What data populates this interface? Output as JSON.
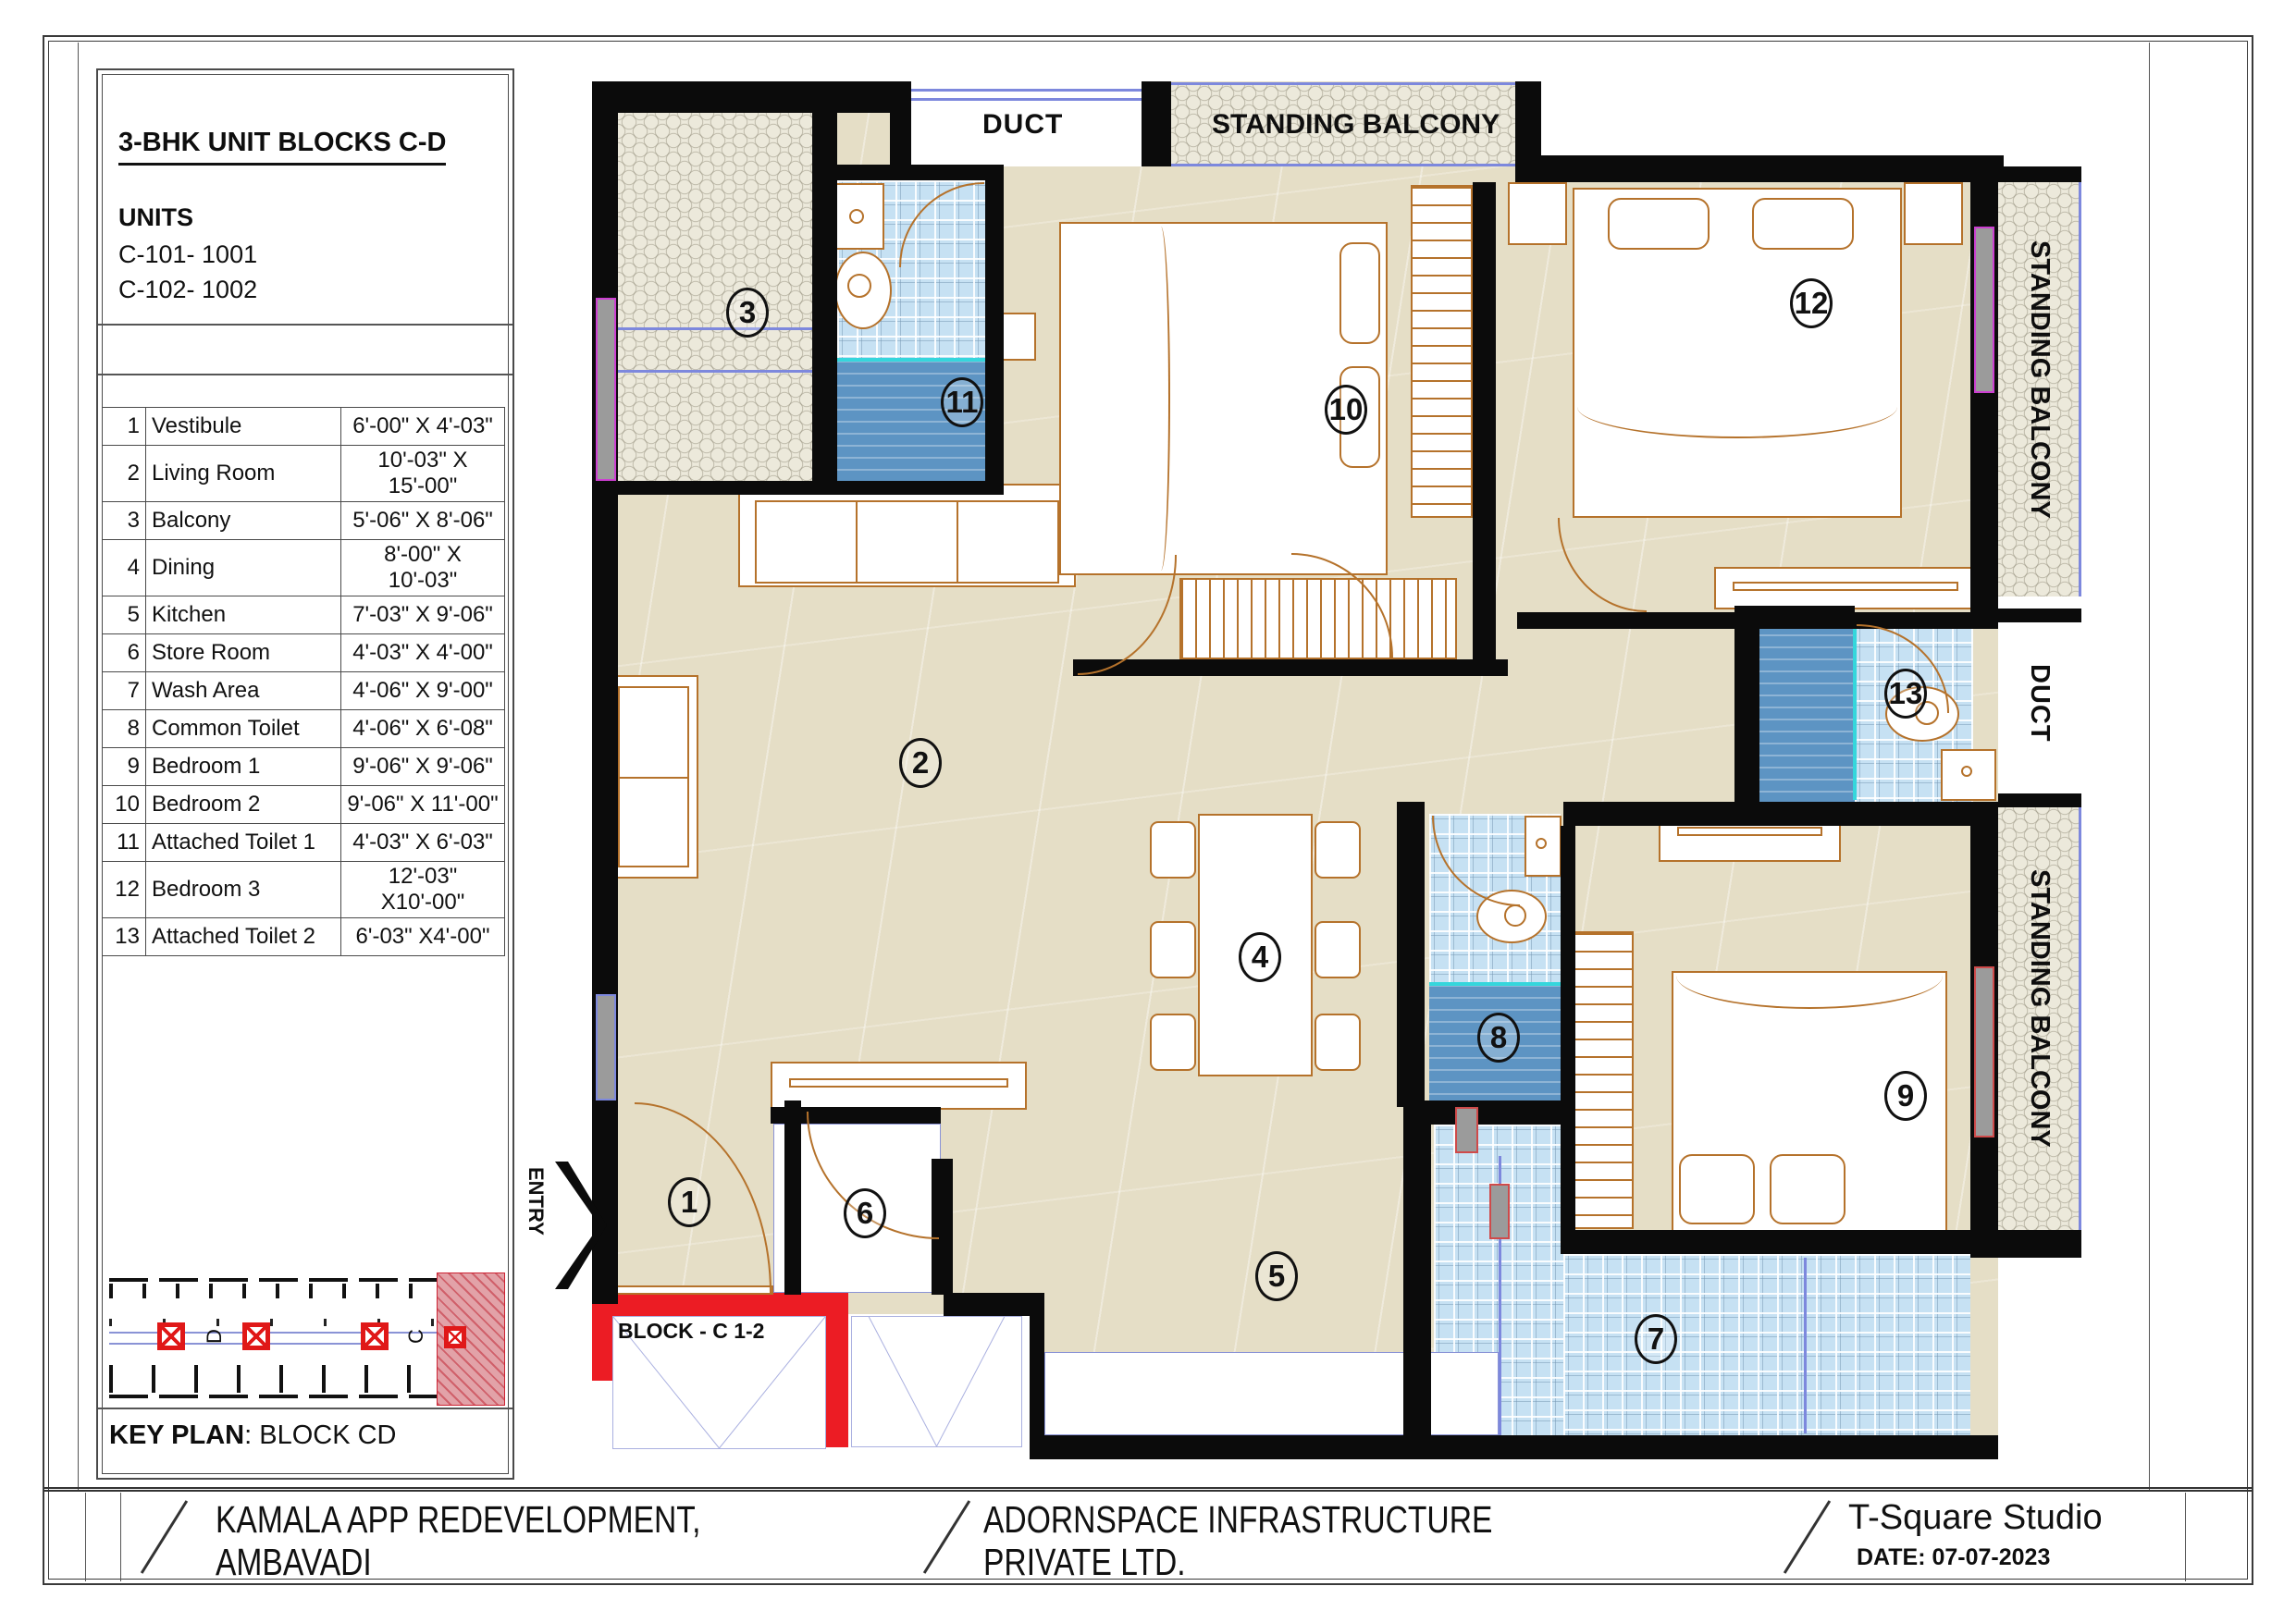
{
  "title_block": {
    "title": "3-BHK UNIT BLOCKS C-D",
    "units_heading": "UNITS",
    "unit_1": "C-101- 1001",
    "unit_2": "C-102- 1002"
  },
  "room_table": {
    "rows": [
      {
        "no": "1",
        "name": "Vestibule",
        "size": "6'-00\" X 4'-03\""
      },
      {
        "no": "2",
        "name": "Living Room",
        "size": "10'-03\" X 15'-00\""
      },
      {
        "no": "3",
        "name": "Balcony",
        "size": "5'-06\" X 8'-06\""
      },
      {
        "no": "4",
        "name": "Dining",
        "size": "8'-00\" X 10'-03\""
      },
      {
        "no": "5",
        "name": "Kitchen",
        "size": "7'-03\" X 9'-06\""
      },
      {
        "no": "6",
        "name": "Store Room",
        "size": "4'-03\" X 4'-00\""
      },
      {
        "no": "7",
        "name": "Wash Area",
        "size": "4'-06\" X 9'-00\""
      },
      {
        "no": "8",
        "name": "Common Toilet",
        "size": "4'-06\" X 6'-08\""
      },
      {
        "no": "9",
        "name": "Bedroom 1",
        "size": "9'-06\" X 9'-06\""
      },
      {
        "no": "10",
        "name": "Bedroom 2",
        "size": "9'-06\" X 11'-00\""
      },
      {
        "no": "11",
        "name": "Attached Toilet 1",
        "size": "4'-03\" X 6'-03\""
      },
      {
        "no": "12",
        "name": "Bedroom 3",
        "size": "12'-03\" X10'-00\""
      },
      {
        "no": "13",
        "name": "Attached Toilet 2",
        "size": "6'-03\" X4'-00\""
      }
    ]
  },
  "key_plan": {
    "label": "KEY PLAN",
    "value": ": BLOCK CD",
    "block_d": "D",
    "block_c": "C"
  },
  "plan": {
    "duct_top": "DUCT",
    "balcony_top": "STANDING BALCONY",
    "balcony_right_upper": "STANDING BALCONY",
    "duct_right": "DUCT",
    "balcony_right_lower": "STANDING BALCONY",
    "entry": "ENTRY",
    "block_label": "BLOCK - C 1-2"
  },
  "footer": {
    "project_line1": "KAMALA APP REDEVELOPMENT,",
    "project_line2": "AMBAVADI",
    "company_line1": "ADORNSPACE INFRASTRUCTURE",
    "company_line2": "PRIVATE LTD.",
    "studio": "T-Square Studio",
    "date": "DATE: 07-07-2023"
  },
  "colors": {
    "wall": "#0b0b0b",
    "floor": "#e5dec6",
    "tile_light": "#c6e1f3",
    "tile_dark": "#5d94c3",
    "furniture_line": "#b5722b",
    "entry_red": "#ec1c24",
    "window_gray": "#9b9b9b",
    "accent_blue": "#7d88dd"
  }
}
